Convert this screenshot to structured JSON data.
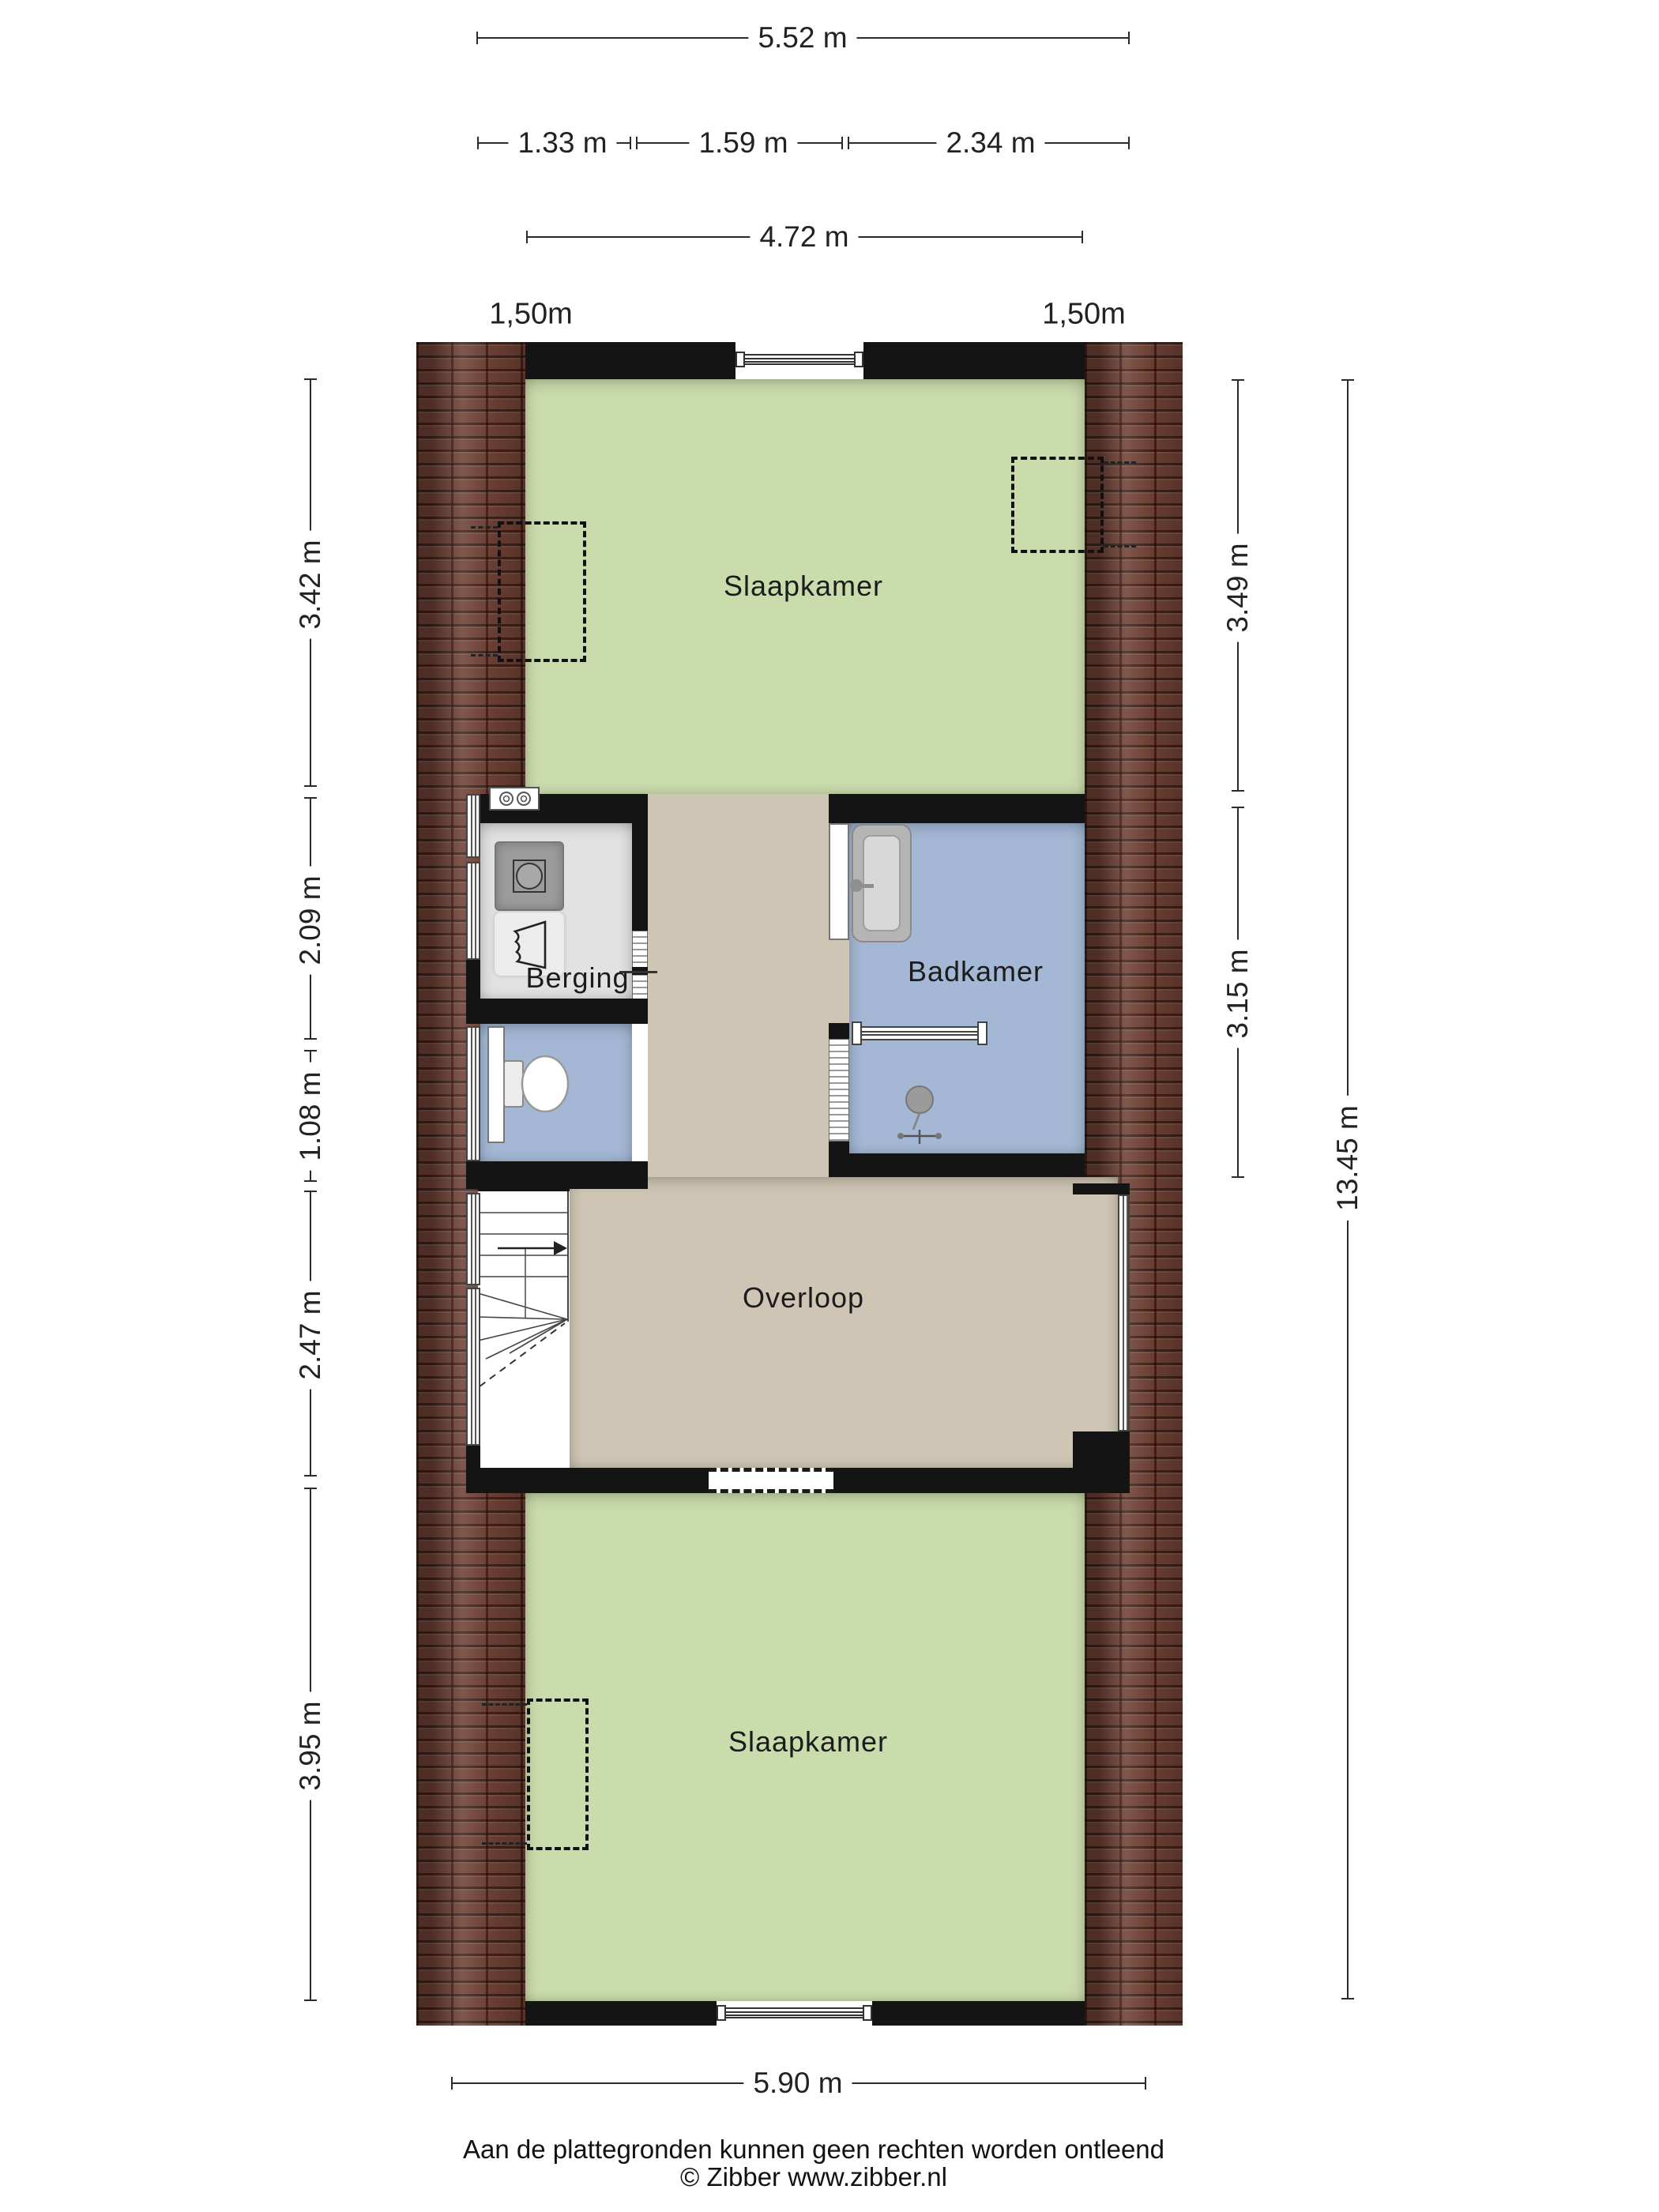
{
  "rooms": {
    "bedroom_top": "Slaapkamer",
    "storage": "Berging",
    "bathroom": "Badkamer",
    "landing": "Overloop",
    "bedroom_bottom": "Slaapkamer"
  },
  "dimensions": {
    "top_total": "5.52 m",
    "top_seg1": "1.33 m",
    "top_seg2": "1.59 m",
    "top_seg3": "2.34 m",
    "top_inner": "4.72 m",
    "headroom_left": "1,50m",
    "headroom_right": "1,50m",
    "left_seg1": "3.42 m",
    "left_seg2": "2.09 m",
    "left_seg3": "1.08 m",
    "left_seg4": "2.47 m",
    "left_seg5": "3.95 m",
    "right_seg1": "3.49 m",
    "right_seg2": "3.15 m",
    "right_total": "13.45 m",
    "bottom_total": "5.90 m"
  },
  "footer": {
    "disclaimer": "Aan de plattegronden kunnen geen rechten worden ontleend",
    "copyright": "© Zibber www.zibber.nl"
  },
  "colors": {
    "floor_green": "#cadbac",
    "floor_beige": "#cfc5b4",
    "floor_blue": "#a4b8d5",
    "floor_gray": "#e2e2e2",
    "wall": "#141414",
    "brick": "#6e4034",
    "line": "#2b2b2b"
  }
}
